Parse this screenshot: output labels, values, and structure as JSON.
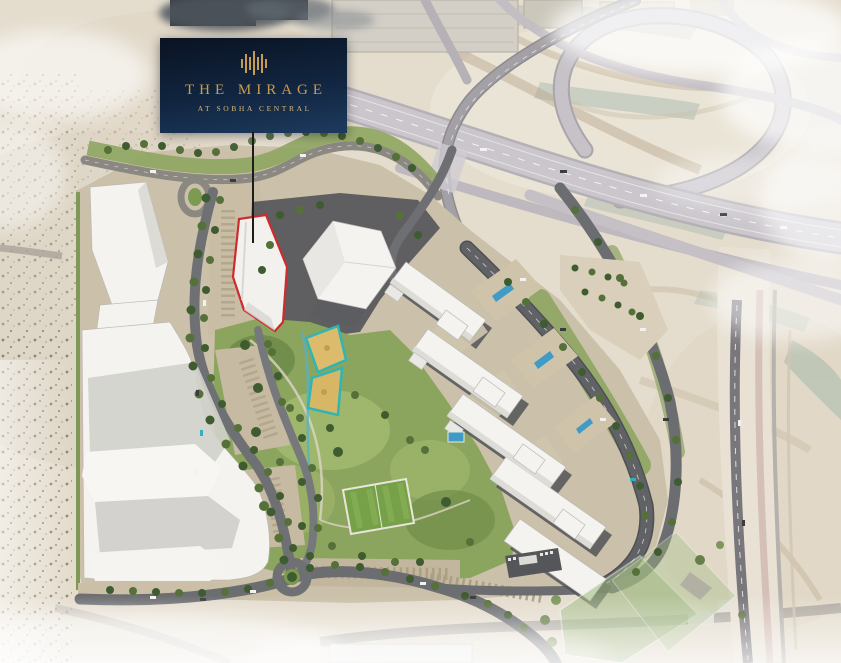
{
  "overlay_card": {
    "title": "THE MIRAGE",
    "subtitle": "AT SOBHA CENTRAL",
    "logo_icon": "sobha-towers-icon"
  },
  "colors": {
    "card_top": "#0a1322",
    "card_bottom": "#1d3a5e",
    "gold": "#c79c4e",
    "gold_soft": "#d8b877",
    "highlight_red": "#cf2b2e",
    "leader": "#1c1c1c"
  }
}
